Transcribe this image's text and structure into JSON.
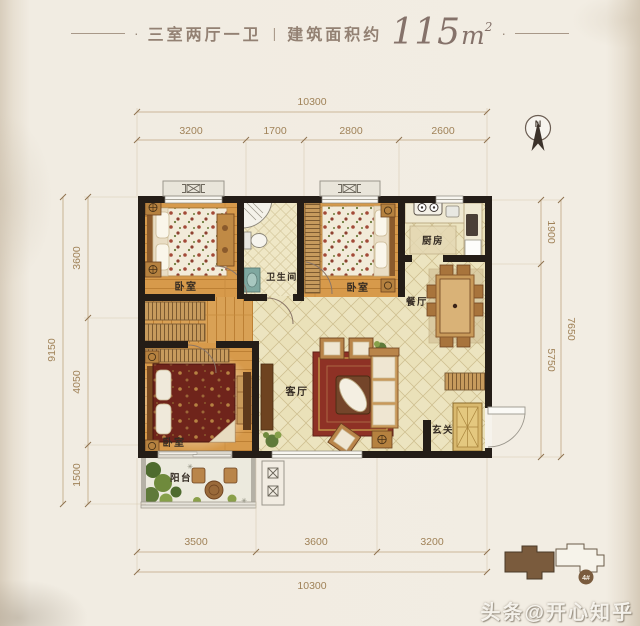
{
  "title": {
    "dash_dot": "·",
    "rooms": "三室两厅一卫",
    "divider": "|",
    "area_prefix": "建筑面积约",
    "area_value": "115",
    "area_unit": "m",
    "area_sup": "2"
  },
  "compass": {
    "north": "N"
  },
  "rooms": {
    "bedroom1": "卧室",
    "bedroom2": "卧室",
    "bedroom3": "卧室",
    "bathroom": "卫生间",
    "kitchen": "厨房",
    "dining": "餐厅",
    "living": "客厅",
    "entry": "玄关",
    "balcony": "阳台"
  },
  "dims": {
    "top": {
      "total": "10300",
      "segments": [
        "3200",
        "1700",
        "2800",
        "2600"
      ]
    },
    "left": {
      "total": "9150",
      "segments": [
        "3600",
        "4050",
        "1500"
      ]
    },
    "right": {
      "total": "7650",
      "segments": [
        "1900",
        "5750"
      ]
    },
    "bottom": {
      "total": "10300",
      "segments": [
        "3500",
        "3600",
        "3200"
      ]
    }
  },
  "key_plan": {
    "unit_label": "4#"
  },
  "watermark": "头条@开心知乎",
  "icons": {
    "sparkle": "✳"
  },
  "colors": {
    "wall": "#241d17",
    "wood_floor": "#d79a4b",
    "tile_floor": "#eae1b9",
    "dimension": "#a08258",
    "brand_brown": "#7a5b3d",
    "title_text": "#8f7d70"
  }
}
